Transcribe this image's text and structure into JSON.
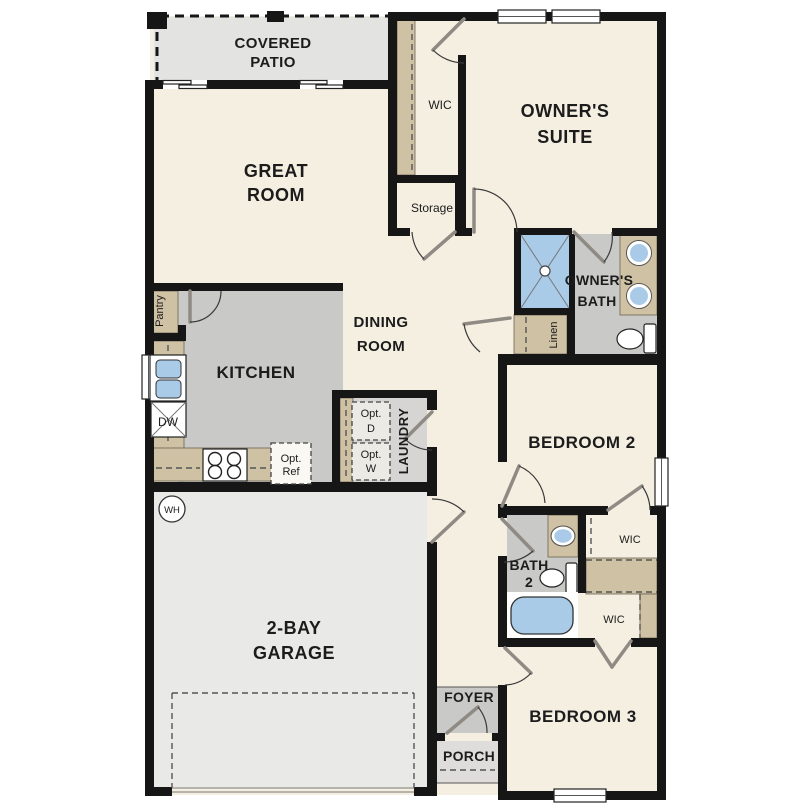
{
  "plan": {
    "rooms": {
      "covered_patio": {
        "line1": "COVERED",
        "line2": "PATIO"
      },
      "great_room": {
        "line1": "GREAT",
        "line2": "ROOM"
      },
      "wic_owner": {
        "label": "WIC"
      },
      "owners_suite": {
        "line1": "OWNER'S",
        "line2": "SUITE"
      },
      "storage": {
        "label": "Storage"
      },
      "owners_bath": {
        "line1": "OWNER'S",
        "line2": "BATH"
      },
      "linen": {
        "label": "Linen"
      },
      "pantry": {
        "label": "Pantry"
      },
      "kitchen": {
        "label": "KITCHEN"
      },
      "dining_room": {
        "line1": "DINING",
        "line2": "ROOM"
      },
      "laundry": {
        "label": "LAUNDRY"
      },
      "opt_dryer": {
        "line1": "Opt.",
        "line2": "D"
      },
      "opt_washer": {
        "line1": "Opt.",
        "line2": "W"
      },
      "opt_fridge": {
        "line1": "Opt.",
        "line2": "Ref"
      },
      "dishwasher": {
        "label": "DW"
      },
      "water_heater": {
        "label": "WH"
      },
      "bedroom2": {
        "label": "BEDROOM 2"
      },
      "bath2": {
        "line1": "BATH",
        "line2": "2"
      },
      "wic_bed2": {
        "label": "WIC"
      },
      "wic_bed3": {
        "label": "WIC"
      },
      "bedroom3": {
        "label": "BEDROOM 3"
      },
      "garage": {
        "line1": "2-BAY",
        "line2": "GARAGE"
      },
      "foyer": {
        "label": "FOYER"
      },
      "porch": {
        "label": "PORCH"
      }
    },
    "colors": {
      "floor_cream": "#f5efe2",
      "floor_hard_gray": "#c9c9c7",
      "floor_garage": "#e9e9e7",
      "floor_patio": "#e3e3e1",
      "floor_laundry": "#d6d5d3",
      "cabinet_tan": "#cfc1a3",
      "fixture_blue": "#a9cbe8",
      "wall_black": "#161616"
    }
  }
}
